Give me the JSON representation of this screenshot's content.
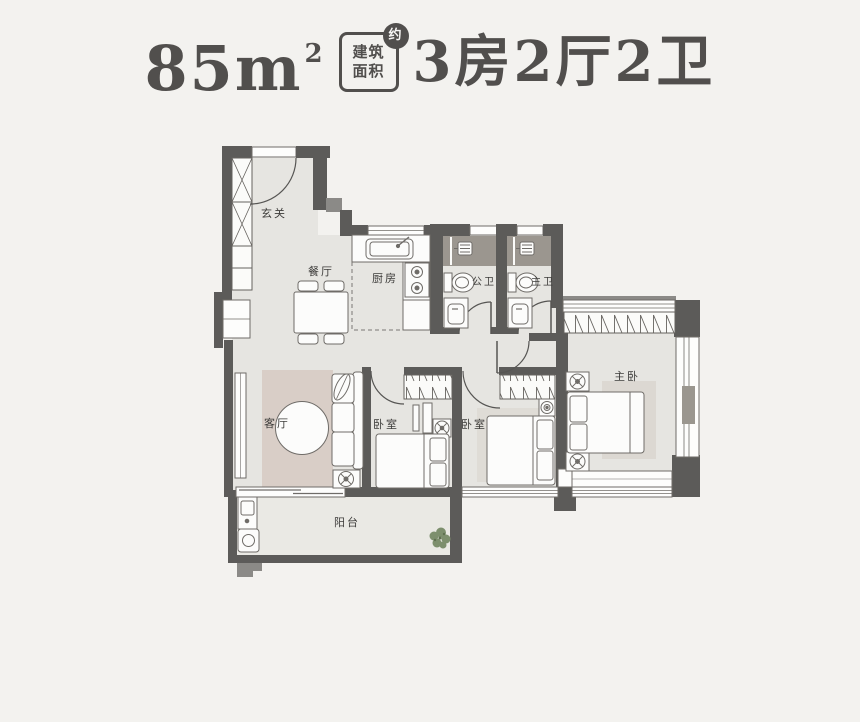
{
  "header": {
    "area_number": "85m",
    "area_superscript": "2",
    "badge_top": "建筑",
    "badge_bottom": "面积",
    "badge_approx": "约",
    "layout_text": "3房2厅2卫"
  },
  "rooms": {
    "entry": "玄关",
    "dining": "餐厅",
    "kitchen": "厨房",
    "public_bath": "公卫",
    "master_bath": "主卫",
    "living": "客厅",
    "bedroom1": "卧室",
    "bedroom2": "卧室",
    "master_bedroom": "主卧",
    "balcony": "阳台"
  },
  "colors": {
    "wall": "#5c5b59",
    "wall_medium": "#8b8a87",
    "floor": "#e6e5e1",
    "balcony_floor": "#eae9e4",
    "living_rug": "#d9cec7",
    "bedroom_rug": "#dfdcd6",
    "master_rug": "#dcd8d2",
    "shower_floor": "#9b968f",
    "title_text": "#514f4d",
    "plant_green": "#7d8f6d"
  }
}
